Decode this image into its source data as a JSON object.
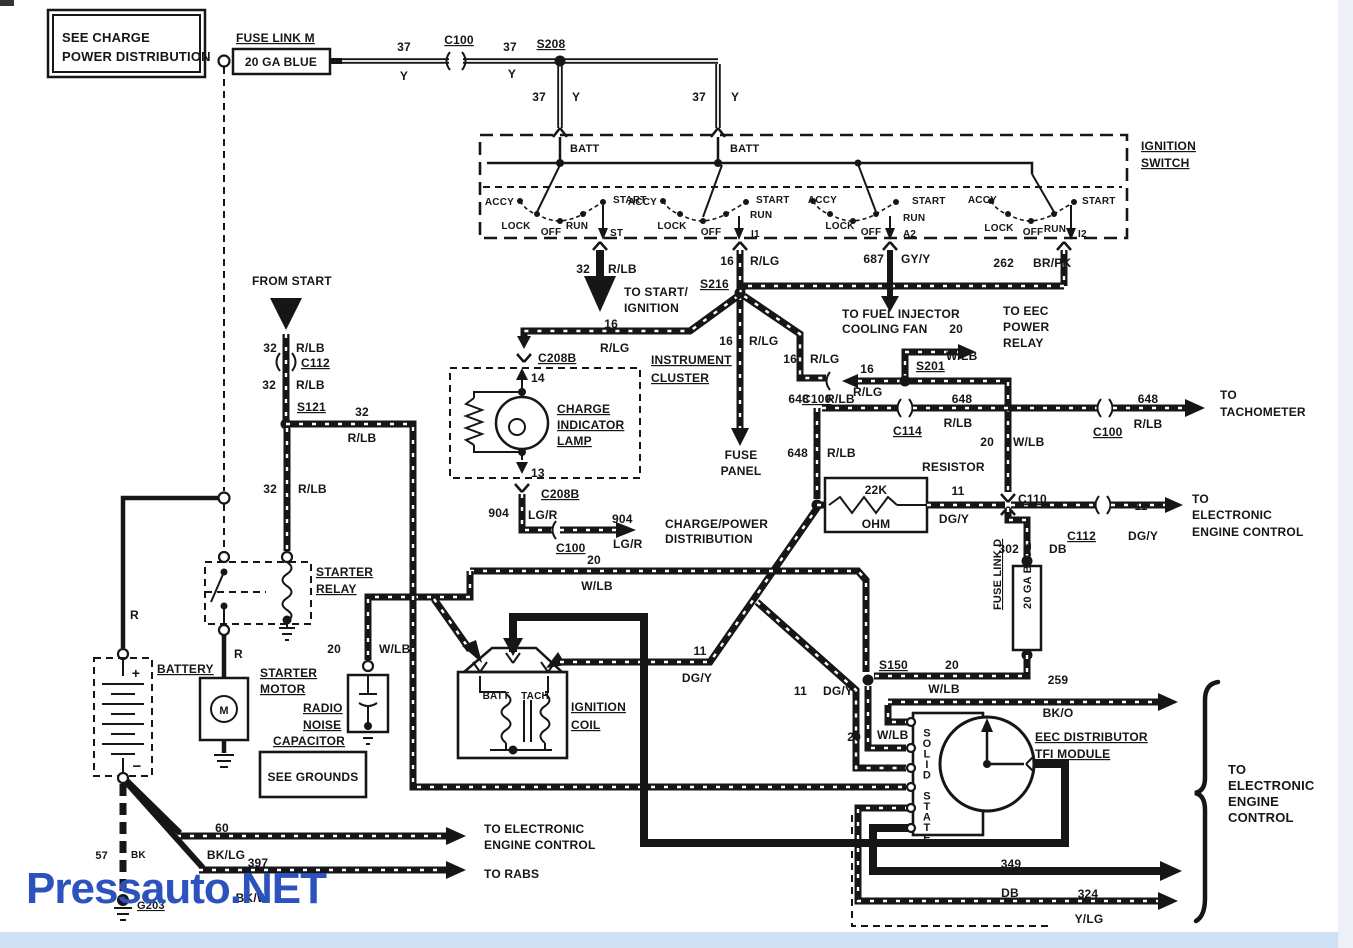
{
  "watermark": {
    "text": "Pressauto.NET",
    "color": "#2b52bd"
  },
  "colors": {
    "bottom_strip": "#cfe0f2",
    "right_strip": "#edf1f7",
    "ink": "#161616",
    "watermark_blue": "#2b52bd"
  },
  "note_box": {
    "line1": "SEE CHARGE",
    "line2": "POWER DISTRIBUTION"
  },
  "labels": [
    {
      "t": "SEE CHARGE",
      "x": 62,
      "y": 42,
      "fs": 13
    },
    {
      "t": "POWER DISTRIBUTION",
      "x": 62,
      "y": 61,
      "fs": 13
    },
    {
      "t": "FUSE LINK M",
      "x": 236,
      "y": 42,
      "fs": 12,
      "u": 1
    },
    {
      "t": "20 GA BLUE",
      "x": 281,
      "y": 66,
      "fs": 12,
      "a": "middle"
    },
    {
      "t": "37",
      "x": 404,
      "y": 51,
      "fs": 12,
      "a": "middle"
    },
    {
      "t": "Y",
      "x": 404,
      "y": 80,
      "fs": 12,
      "a": "middle"
    },
    {
      "t": "C100",
      "x": 459,
      "y": 44,
      "fs": 12,
      "u": 1,
      "a": "middle"
    },
    {
      "t": "37",
      "x": 510,
      "y": 51,
      "fs": 12,
      "a": "middle"
    },
    {
      "t": "Y",
      "x": 512,
      "y": 78,
      "fs": 12,
      "a": "middle"
    },
    {
      "t": "S208",
      "x": 551,
      "y": 48,
      "fs": 12,
      "u": 1,
      "a": "middle"
    },
    {
      "t": "37",
      "x": 546,
      "y": 101,
      "fs": 12,
      "a": "end"
    },
    {
      "t": "Y",
      "x": 572,
      "y": 101,
      "fs": 12
    },
    {
      "t": "37",
      "x": 706,
      "y": 101,
      "fs": 12,
      "a": "end"
    },
    {
      "t": "Y",
      "x": 731,
      "y": 101,
      "fs": 12
    },
    {
      "t": "BATT",
      "x": 570,
      "y": 152,
      "fs": 11
    },
    {
      "t": "BATT",
      "x": 730,
      "y": 152,
      "fs": 11
    },
    {
      "t": "IGNITION",
      "x": 1141,
      "y": 150,
      "fs": 12,
      "u": 1
    },
    {
      "t": "SWITCH",
      "x": 1141,
      "y": 167,
      "fs": 12,
      "u": 1
    },
    {
      "t": "ACCY",
      "x": 514,
      "y": 205,
      "fs": 10,
      "a": "end"
    },
    {
      "t": "START",
      "x": 613,
      "y": 203,
      "fs": 10
    },
    {
      "t": "LOCK",
      "x": 516,
      "y": 229,
      "fs": 10,
      "a": "middle"
    },
    {
      "t": "OFF",
      "x": 551,
      "y": 235,
      "fs": 10,
      "a": "middle"
    },
    {
      "t": "RUN",
      "x": 577,
      "y": 229,
      "fs": 10,
      "a": "middle"
    },
    {
      "t": "ST",
      "x": 610,
      "y": 236,
      "fs": 10
    },
    {
      "t": "ACCY",
      "x": 657,
      "y": 205,
      "fs": 10,
      "a": "end"
    },
    {
      "t": "START",
      "x": 756,
      "y": 203,
      "fs": 10
    },
    {
      "t": "LOCK",
      "x": 672,
      "y": 229,
      "fs": 10,
      "a": "middle"
    },
    {
      "t": "OFF",
      "x": 711,
      "y": 235,
      "fs": 10,
      "a": "middle"
    },
    {
      "t": "RUN",
      "x": 750,
      "y": 218,
      "fs": 10
    },
    {
      "t": "I1",
      "x": 751,
      "y": 237,
      "fs": 10
    },
    {
      "t": "ACCY",
      "x": 837,
      "y": 203,
      "fs": 10,
      "a": "end"
    },
    {
      "t": "START",
      "x": 912,
      "y": 204,
      "fs": 10
    },
    {
      "t": "LOCK",
      "x": 840,
      "y": 229,
      "fs": 10,
      "a": "middle"
    },
    {
      "t": "OFF",
      "x": 871,
      "y": 235,
      "fs": 10,
      "a": "middle"
    },
    {
      "t": "RUN",
      "x": 903,
      "y": 221,
      "fs": 10
    },
    {
      "t": "A2",
      "x": 903,
      "y": 237,
      "fs": 10
    },
    {
      "t": "ACCY",
      "x": 997,
      "y": 203,
      "fs": 10,
      "a": "end"
    },
    {
      "t": "START",
      "x": 1082,
      "y": 204,
      "fs": 10
    },
    {
      "t": "LOCK",
      "x": 999,
      "y": 231,
      "fs": 10,
      "a": "middle"
    },
    {
      "t": "OFF",
      "x": 1033,
      "y": 235,
      "fs": 10,
      "a": "middle"
    },
    {
      "t": "RUN",
      "x": 1055,
      "y": 232,
      "fs": 10,
      "a": "middle"
    },
    {
      "t": "I2",
      "x": 1078,
      "y": 237,
      "fs": 10
    },
    {
      "t": "687",
      "x": 884,
      "y": 263,
      "fs": 12,
      "a": "end"
    },
    {
      "t": "GY/Y",
      "x": 901,
      "y": 263,
      "fs": 12
    },
    {
      "t": "262",
      "x": 1014,
      "y": 267,
      "fs": 12,
      "a": "end"
    },
    {
      "t": "BR/PK",
      "x": 1033,
      "y": 267,
      "fs": 12
    },
    {
      "t": "32",
      "x": 590,
      "y": 273,
      "fs": 12,
      "a": "end"
    },
    {
      "t": "R/LB",
      "x": 608,
      "y": 273,
      "fs": 12
    },
    {
      "t": "TO START/",
      "x": 624,
      "y": 296,
      "fs": 12
    },
    {
      "t": "IGNITION",
      "x": 624,
      "y": 312,
      "fs": 12
    },
    {
      "t": "S216",
      "x": 700,
      "y": 288,
      "fs": 12,
      "u": 1
    },
    {
      "t": "16",
      "x": 734,
      "y": 265,
      "fs": 12,
      "a": "end"
    },
    {
      "t": "R/LG",
      "x": 750,
      "y": 265,
      "fs": 12
    },
    {
      "t": "TO FUEL INJECTOR",
      "x": 842,
      "y": 318,
      "fs": 12
    },
    {
      "t": "COOLING FAN",
      "x": 842,
      "y": 333,
      "fs": 12
    },
    {
      "t": "20",
      "x": 963,
      "y": 333,
      "fs": 12,
      "a": "end"
    },
    {
      "t": "W/LB",
      "x": 946,
      "y": 360,
      "fs": 12
    },
    {
      "t": "TO EEC",
      "x": 1003,
      "y": 315,
      "fs": 12
    },
    {
      "t": "POWER",
      "x": 1003,
      "y": 331,
      "fs": 12
    },
    {
      "t": "RELAY",
      "x": 1003,
      "y": 347,
      "fs": 12
    },
    {
      "t": "S201",
      "x": 916,
      "y": 370,
      "fs": 12,
      "u": 1
    },
    {
      "t": "16",
      "x": 874,
      "y": 373,
      "fs": 12,
      "a": "end"
    },
    {
      "t": "R/LG",
      "x": 853,
      "y": 396,
      "fs": 12
    },
    {
      "t": "C100",
      "x": 802,
      "y": 403,
      "fs": 12,
      "u": 1
    },
    {
      "t": "16",
      "x": 797,
      "y": 363,
      "fs": 12,
      "a": "end"
    },
    {
      "t": "R/LG",
      "x": 810,
      "y": 363,
      "fs": 12
    },
    {
      "t": "16",
      "x": 618,
      "y": 328,
      "fs": 12,
      "a": "end"
    },
    {
      "t": "R/LG",
      "x": 600,
      "y": 352,
      "fs": 12
    },
    {
      "t": "INSTRUMENT",
      "x": 651,
      "y": 364,
      "fs": 12,
      "u": 1
    },
    {
      "t": "CLUSTER",
      "x": 651,
      "y": 382,
      "fs": 12,
      "u": 1
    },
    {
      "t": "16",
      "x": 733,
      "y": 345,
      "fs": 12,
      "a": "end"
    },
    {
      "t": "R/LG",
      "x": 749,
      "y": 345,
      "fs": 12
    },
    {
      "t": "FUSE",
      "x": 741,
      "y": 459,
      "fs": 12,
      "a": "middle"
    },
    {
      "t": "PANEL",
      "x": 741,
      "y": 475,
      "fs": 12,
      "a": "middle"
    },
    {
      "t": "CHARGE",
      "x": 557,
      "y": 413,
      "fs": 12,
      "u": 1
    },
    {
      "t": "INDICATOR",
      "x": 557,
      "y": 429,
      "fs": 12,
      "u": 1
    },
    {
      "t": "LAMP",
      "x": 557,
      "y": 445,
      "fs": 12,
      "u": 1
    },
    {
      "t": "C208B",
      "x": 538,
      "y": 362,
      "fs": 12,
      "u": 1
    },
    {
      "t": "14",
      "x": 531,
      "y": 382,
      "fs": 12
    },
    {
      "t": "13",
      "x": 531,
      "y": 477,
      "fs": 12
    },
    {
      "t": "C208B",
      "x": 541,
      "y": 498,
      "fs": 12,
      "u": 1
    },
    {
      "t": "904",
      "x": 509,
      "y": 517,
      "fs": 12,
      "a": "end"
    },
    {
      "t": "LG/R",
      "x": 528,
      "y": 519,
      "fs": 12
    },
    {
      "t": "C100",
      "x": 556,
      "y": 552,
      "fs": 12,
      "u": 1
    },
    {
      "t": "904",
      "x": 612,
      "y": 523,
      "fs": 12
    },
    {
      "t": "LG/R",
      "x": 613,
      "y": 548,
      "fs": 12
    },
    {
      "t": "CHARGE/POWER",
      "x": 665,
      "y": 528,
      "fs": 12
    },
    {
      "t": "DISTRIBUTION",
      "x": 665,
      "y": 543,
      "fs": 12
    },
    {
      "t": "C114",
      "x": 893,
      "y": 435,
      "fs": 12,
      "u": 1
    },
    {
      "t": "648",
      "x": 962,
      "y": 403,
      "fs": 12,
      "a": "middle"
    },
    {
      "t": "R/LB",
      "x": 958,
      "y": 427,
      "fs": 12,
      "a": "middle"
    },
    {
      "t": "RESISTOR",
      "x": 922,
      "y": 471,
      "fs": 12
    },
    {
      "t": "22K",
      "x": 876,
      "y": 494,
      "fs": 12,
      "a": "middle"
    },
    {
      "t": "OHM",
      "x": 876,
      "y": 528,
      "fs": 12,
      "a": "middle"
    },
    {
      "t": "648",
      "x": 809,
      "y": 403,
      "fs": 12,
      "a": "end"
    },
    {
      "t": "R/LB",
      "x": 826,
      "y": 403,
      "fs": 12
    },
    {
      "t": "648",
      "x": 808,
      "y": 457,
      "fs": 12,
      "a": "end"
    },
    {
      "t": "R/LB",
      "x": 827,
      "y": 457,
      "fs": 12
    },
    {
      "t": "11",
      "x": 958,
      "y": 495,
      "fs": 12,
      "a": "middle"
    },
    {
      "t": "DG/Y",
      "x": 954,
      "y": 523,
      "fs": 12,
      "a": "middle"
    },
    {
      "t": "C110",
      "x": 1018,
      "y": 503,
      "fs": 12,
      "u": 1
    },
    {
      "t": "20",
      "x": 994,
      "y": 446,
      "fs": 12,
      "a": "end"
    },
    {
      "t": "W/LB",
      "x": 1013,
      "y": 446,
      "fs": 12
    },
    {
      "t": "648",
      "x": 1148,
      "y": 403,
      "fs": 12,
      "a": "middle"
    },
    {
      "t": "R/LB",
      "x": 1148,
      "y": 428,
      "fs": 12,
      "a": "middle"
    },
    {
      "t": "C100",
      "x": 1093,
      "y": 436,
      "fs": 12,
      "u": 1
    },
    {
      "t": "TO",
      "x": 1220,
      "y": 399,
      "fs": 12
    },
    {
      "t": "TACHOMETER",
      "x": 1220,
      "y": 416,
      "fs": 12
    },
    {
      "t": "11",
      "x": 1141,
      "y": 510,
      "fs": 12,
      "a": "middle"
    },
    {
      "t": "DG/Y",
      "x": 1128,
      "y": 540,
      "fs": 12
    },
    {
      "t": "C112",
      "x": 1096,
      "y": 540,
      "fs": 12,
      "u": 1,
      "a": "end"
    },
    {
      "t": "TO",
      "x": 1192,
      "y": 503,
      "fs": 12
    },
    {
      "t": "ELECTRONIC",
      "x": 1192,
      "y": 519,
      "fs": 12
    },
    {
      "t": "ENGINE CONTROL",
      "x": 1192,
      "y": 536,
      "fs": 12
    },
    {
      "t": "302",
      "x": 1019,
      "y": 553,
      "fs": 12,
      "a": "end"
    },
    {
      "t": "DB",
      "x": 1049,
      "y": 553,
      "fs": 12
    },
    {
      "t": "FUSE LINK D",
      "x": 1001,
      "y": 610,
      "fs": 11,
      "u": 1,
      "r": -90
    },
    {
      "t": "20 GA BLUE",
      "x": 1031,
      "y": 609,
      "fs": 11,
      "r": -90
    },
    {
      "t": "S150",
      "x": 879,
      "y": 669,
      "fs": 12,
      "u": 1
    },
    {
      "t": "20",
      "x": 952,
      "y": 669,
      "fs": 12,
      "a": "middle"
    },
    {
      "t": "W/LB",
      "x": 944,
      "y": 693,
      "fs": 12,
      "a": "middle"
    },
    {
      "t": "11",
      "x": 807,
      "y": 695,
      "fs": 12,
      "a": "end"
    },
    {
      "t": "DG/Y",
      "x": 823,
      "y": 695,
      "fs": 12
    },
    {
      "t": "20",
      "x": 861,
      "y": 741,
      "fs": 12,
      "a": "end"
    },
    {
      "t": "W/LB",
      "x": 877,
      "y": 739,
      "fs": 12
    },
    {
      "t": "259",
      "x": 1058,
      "y": 684,
      "fs": 12,
      "a": "middle"
    },
    {
      "t": "BK/O",
      "x": 1058,
      "y": 717,
      "fs": 12,
      "a": "middle"
    },
    {
      "t": "EEC DISTRIBUTOR",
      "x": 1035,
      "y": 741,
      "fs": 12,
      "u": 1
    },
    {
      "t": "TFI MODULE",
      "x": 1035,
      "y": 758,
      "fs": 12,
      "u": 1
    },
    {
      "t": "SOLID STATE",
      "x": 927,
      "y": 726,
      "fs": 11,
      "a": "middle",
      "stack": 1
    },
    {
      "t": "349",
      "x": 1011,
      "y": 868,
      "fs": 12,
      "a": "middle"
    },
    {
      "t": "DB",
      "x": 1010,
      "y": 897,
      "fs": 12,
      "a": "middle"
    },
    {
      "t": "324",
      "x": 1088,
      "y": 898,
      "fs": 12,
      "a": "middle"
    },
    {
      "t": "Y/LG",
      "x": 1089,
      "y": 923,
      "fs": 12,
      "a": "middle"
    },
    {
      "t": "TO",
      "x": 1228,
      "y": 774,
      "fs": 13
    },
    {
      "t": "ELECTRONIC",
      "x": 1228,
      "y": 790,
      "fs": 13
    },
    {
      "t": "ENGINE",
      "x": 1228,
      "y": 806,
      "fs": 13
    },
    {
      "t": "CONTROL",
      "x": 1228,
      "y": 822,
      "fs": 13
    },
    {
      "t": "11",
      "x": 700,
      "y": 655,
      "fs": 12,
      "a": "middle"
    },
    {
      "t": "DG/Y",
      "x": 697,
      "y": 682,
      "fs": 12,
      "a": "middle"
    },
    {
      "t": "20",
      "x": 594,
      "y": 564,
      "fs": 12,
      "a": "middle"
    },
    {
      "t": "W/LB",
      "x": 597,
      "y": 590,
      "fs": 12,
      "a": "middle"
    },
    {
      "t": "IGNITION",
      "x": 571,
      "y": 711,
      "fs": 12,
      "u": 1
    },
    {
      "t": "COIL",
      "x": 571,
      "y": 729,
      "fs": 12,
      "u": 1
    },
    {
      "t": "BATT",
      "x": 496,
      "y": 699,
      "fs": 10,
      "a": "middle"
    },
    {
      "t": "TACH",
      "x": 535,
      "y": 699,
      "fs": 10,
      "a": "middle"
    },
    {
      "t": "FROM START",
      "x": 252,
      "y": 285,
      "fs": 12
    },
    {
      "t": "32",
      "x": 277,
      "y": 352,
      "fs": 12,
      "a": "end"
    },
    {
      "t": "R/LB",
      "x": 296,
      "y": 352,
      "fs": 12
    },
    {
      "t": "C112",
      "x": 301,
      "y": 367,
      "fs": 12,
      "u": 1
    },
    {
      "t": "32",
      "x": 276,
      "y": 389,
      "fs": 12,
      "a": "end"
    },
    {
      "t": "R/LB",
      "x": 296,
      "y": 389,
      "fs": 12
    },
    {
      "t": "S121",
      "x": 297,
      "y": 411,
      "fs": 12,
      "u": 1
    },
    {
      "t": "32",
      "x": 362,
      "y": 416,
      "fs": 12,
      "a": "middle"
    },
    {
      "t": "R/LB",
      "x": 362,
      "y": 442,
      "fs": 12,
      "a": "middle"
    },
    {
      "t": "32",
      "x": 277,
      "y": 493,
      "fs": 12,
      "a": "end"
    },
    {
      "t": "R/LB",
      "x": 298,
      "y": 493,
      "fs": 12
    },
    {
      "t": "STARTER",
      "x": 316,
      "y": 576,
      "fs": 12,
      "u": 1
    },
    {
      "t": "RELAY",
      "x": 316,
      "y": 593,
      "fs": 12,
      "u": 1
    },
    {
      "t": "BATTERY",
      "x": 157,
      "y": 673,
      "fs": 12,
      "u": 1
    },
    {
      "t": "+",
      "x": 136,
      "y": 678,
      "fs": 14,
      "a": "middle"
    },
    {
      "t": "−",
      "x": 137,
      "y": 771,
      "fs": 15,
      "a": "middle"
    },
    {
      "t": "R",
      "x": 130,
      "y": 619,
      "fs": 12
    },
    {
      "t": "R",
      "x": 234,
      "y": 658,
      "fs": 12
    },
    {
      "t": "STARTER",
      "x": 260,
      "y": 677,
      "fs": 12,
      "u": 1
    },
    {
      "t": "MOTOR",
      "x": 260,
      "y": 693,
      "fs": 12,
      "u": 1
    },
    {
      "t": "M",
      "x": 224,
      "y": 714,
      "fs": 11,
      "a": "middle"
    },
    {
      "t": "RADIO",
      "x": 303,
      "y": 712,
      "fs": 12,
      "u": 1
    },
    {
      "t": "NOISE",
      "x": 303,
      "y": 729,
      "fs": 12,
      "u": 1
    },
    {
      "t": "CAPACITOR",
      "x": 273,
      "y": 745,
      "fs": 12,
      "u": 1
    },
    {
      "t": "20",
      "x": 341,
      "y": 653,
      "fs": 12,
      "a": "end"
    },
    {
      "t": "W/LB",
      "x": 379,
      "y": 653,
      "fs": 12
    },
    {
      "t": "SEE GROUNDS",
      "x": 313,
      "y": 781,
      "fs": 12,
      "a": "middle"
    },
    {
      "t": "57",
      "x": 108,
      "y": 859,
      "fs": 11,
      "a": "end"
    },
    {
      "t": "BK",
      "x": 131,
      "y": 858,
      "fs": 10
    },
    {
      "t": "G203",
      "x": 137,
      "y": 909,
      "fs": 11,
      "u": 1
    },
    {
      "t": "60",
      "x": 222,
      "y": 832,
      "fs": 12,
      "a": "middle"
    },
    {
      "t": "BK/LG",
      "x": 226,
      "y": 859,
      "fs": 12,
      "a": "middle"
    },
    {
      "t": "TO ELECTRONIC",
      "x": 484,
      "y": 833,
      "fs": 12
    },
    {
      "t": "ENGINE CONTROL",
      "x": 484,
      "y": 849,
      "fs": 12
    },
    {
      "t": "397",
      "x": 258,
      "y": 867,
      "fs": 12,
      "a": "middle"
    },
    {
      "t": "BK/W",
      "x": 252,
      "y": 902,
      "fs": 12,
      "a": "middle"
    },
    {
      "t": "TO RABS",
      "x": 484,
      "y": 878,
      "fs": 12
    },
    {
      "t": "M",
      "x": 600,
      "y": 302,
      "fs": 13,
      "a": "middle",
      "fill": "#ffffff"
    },
    {
      "t": "N",
      "x": 286,
      "y": 319,
      "fs": 13,
      "a": "middle",
      "fill": "#ffffff"
    }
  ]
}
